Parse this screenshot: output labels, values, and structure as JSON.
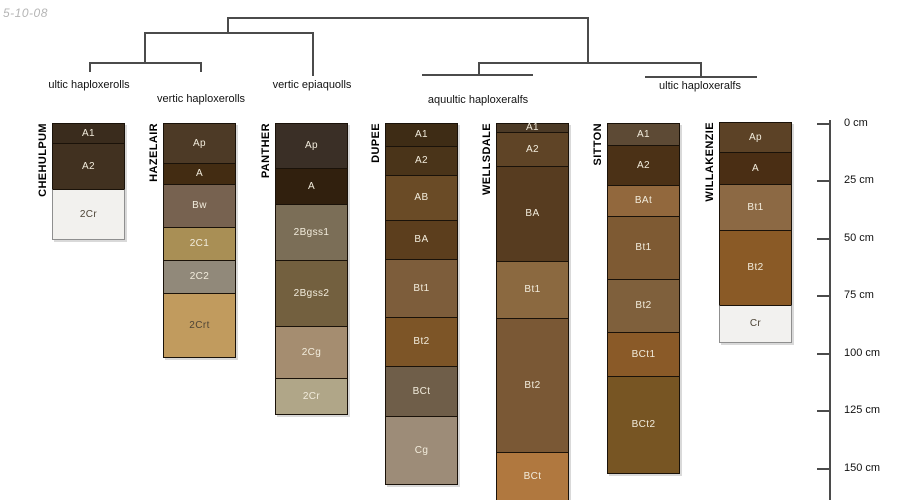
{
  "date_stamp": "5-10-08",
  "dendrogram": {
    "line_color": "#4b4b4b",
    "labels": [
      {
        "text": "ultic haploxerolls",
        "cx": 89,
        "y": 79
      },
      {
        "text": "vertic haploxerolls",
        "cx": 201,
        "y": 93
      },
      {
        "text": "vertic epiaquolls",
        "cx": 312,
        "y": 79
      },
      {
        "text": "aquultic haploxeralfs",
        "cx": 478,
        "y": 94
      },
      {
        "text": "ultic haploxeralfs",
        "cx": 700,
        "y": 80
      }
    ],
    "lines": [
      {
        "o": "h",
        "x": 227,
        "y": 17,
        "len": 362
      },
      {
        "o": "v",
        "x": 227,
        "y": 17,
        "len": 16
      },
      {
        "o": "h",
        "x": 144,
        "y": 32,
        "len": 169
      },
      {
        "o": "v",
        "x": 144,
        "y": 32,
        "len": 31
      },
      {
        "o": "h",
        "x": 89,
        "y": 62,
        "len": 112
      },
      {
        "o": "v",
        "x": 89,
        "y": 62,
        "len": 10
      },
      {
        "o": "v",
        "x": 200,
        "y": 62,
        "len": 10
      },
      {
        "o": "v",
        "x": 312,
        "y": 32,
        "len": 44
      },
      {
        "o": "v",
        "x": 587,
        "y": 17,
        "len": 46
      },
      {
        "o": "h",
        "x": 478,
        "y": 62,
        "len": 223
      },
      {
        "o": "v",
        "x": 478,
        "y": 62,
        "len": 13
      },
      {
        "o": "h",
        "x": 422,
        "y": 74,
        "len": 111
      },
      {
        "o": "v",
        "x": 700,
        "y": 62,
        "len": 15
      },
      {
        "o": "h",
        "x": 645,
        "y": 76,
        "len": 112
      }
    ]
  },
  "profiles": [
    {
      "name": "CHEHULPUM",
      "left": 52,
      "top": 123,
      "width": 73,
      "horizons": [
        {
          "label": "A1",
          "h": 21,
          "color": "#3a2c1d",
          "text": "light"
        },
        {
          "label": "A2",
          "h": 47,
          "color": "#413120",
          "text": "light"
        },
        {
          "label": "2Cr",
          "h": 51,
          "color": "#f2f1ee",
          "text": "dark",
          "frame": "gray"
        }
      ]
    },
    {
      "name": "HAZELAIR",
      "left": 163,
      "top": 123,
      "width": 73,
      "horizons": [
        {
          "label": "Ap",
          "h": 41,
          "color": "#4d3a26",
          "text": "light"
        },
        {
          "label": "A",
          "h": 22,
          "color": "#432c12",
          "text": "light"
        },
        {
          "label": "Bw",
          "h": 44,
          "color": "#776250",
          "text": "light"
        },
        {
          "label": "2C1",
          "h": 34,
          "color": "#a98f55",
          "text": "light"
        },
        {
          "label": "2C2",
          "h": 34,
          "color": "#91897a",
          "text": "light"
        },
        {
          "label": "2Crt",
          "h": 65,
          "color": "#c19b5e",
          "text": "dark"
        }
      ]
    },
    {
      "name": "PANTHER",
      "left": 275,
      "top": 123,
      "width": 73,
      "horizons": [
        {
          "label": "Ap",
          "h": 46,
          "color": "#3a2f26",
          "text": "light"
        },
        {
          "label": "A",
          "h": 37,
          "color": "#31200e",
          "text": "light"
        },
        {
          "label": "2Bgss1",
          "h": 57,
          "color": "#7b6e57",
          "text": "light"
        },
        {
          "label": "2Bgss2",
          "h": 67,
          "color": "#73603f",
          "text": "light"
        },
        {
          "label": "2Cg",
          "h": 53,
          "color": "#a58d70",
          "text": "light"
        },
        {
          "label": "2Cr",
          "h": 37,
          "color": "#b0a688",
          "text": "light"
        }
      ]
    },
    {
      "name": "DUPEE",
      "left": 385,
      "top": 123,
      "width": 73,
      "horizons": [
        {
          "label": "A1",
          "h": 24,
          "color": "#3e2c15",
          "text": "light"
        },
        {
          "label": "A2",
          "h": 30,
          "color": "#4a3419",
          "text": "light"
        },
        {
          "label": "AB",
          "h": 46,
          "color": "#6a4b26",
          "text": "light"
        },
        {
          "label": "BA",
          "h": 40,
          "color": "#5c3e1d",
          "text": "light"
        },
        {
          "label": "Bt1",
          "h": 59,
          "color": "#7d5d3b",
          "text": "light"
        },
        {
          "label": "Bt2",
          "h": 50,
          "color": "#7d5527",
          "text": "light"
        },
        {
          "label": "BCt",
          "h": 51,
          "color": "#6f5e49",
          "text": "light"
        },
        {
          "label": "Cg",
          "h": 69,
          "color": "#9d8c78",
          "text": "light"
        }
      ]
    },
    {
      "name": "WELLSDALE",
      "left": 496,
      "top": 123,
      "width": 73,
      "horizons": [
        {
          "label": "A1",
          "h": 10,
          "color": "#4c3a26",
          "text": "light"
        },
        {
          "label": "A2",
          "h": 35,
          "color": "#5f4426",
          "text": "light"
        },
        {
          "label": "BA",
          "h": 96,
          "color": "#573c20",
          "text": "light"
        },
        {
          "label": "Bt1",
          "h": 58,
          "color": "#8b6940",
          "text": "light"
        },
        {
          "label": "Bt2",
          "h": 135,
          "color": "#7a5835",
          "text": "light"
        },
        {
          "label": "BCt",
          "h": 50,
          "color": "#b0783f",
          "text": "light"
        }
      ]
    },
    {
      "name": "SITTON",
      "left": 607,
      "top": 123,
      "width": 73,
      "horizons": [
        {
          "label": "A1",
          "h": 23,
          "color": "#5d4a35",
          "text": "light"
        },
        {
          "label": "A2",
          "h": 41,
          "color": "#4b3116",
          "text": "light"
        },
        {
          "label": "BAt",
          "h": 32,
          "color": "#92683d",
          "text": "light"
        },
        {
          "label": "Bt1",
          "h": 64,
          "color": "#7e5a33",
          "text": "light"
        },
        {
          "label": "Bt2",
          "h": 54,
          "color": "#7f603c",
          "text": "light"
        },
        {
          "label": "BCt1",
          "h": 45,
          "color": "#8a5a28",
          "text": "light"
        },
        {
          "label": "BCt2",
          "h": 98,
          "color": "#775523",
          "text": "light"
        }
      ]
    },
    {
      "name": "WILLAKENZIE",
      "left": 719,
      "top": 122,
      "width": 73,
      "horizons": [
        {
          "label": "Ap",
          "h": 31,
          "color": "#5c4226",
          "text": "light"
        },
        {
          "label": "A",
          "h": 33,
          "color": "#4a2e14",
          "text": "light"
        },
        {
          "label": "Bt1",
          "h": 47,
          "color": "#8c6944",
          "text": "light"
        },
        {
          "label": "Bt2",
          "h": 76,
          "color": "#8a5a26",
          "text": "light"
        },
        {
          "label": "Cr",
          "h": 38,
          "color": "#f2f1ef",
          "text": "dark",
          "frame": "gray"
        }
      ]
    }
  ],
  "depth_scale": {
    "unit": "cm",
    "axis_x": 829,
    "axis_top": 120,
    "axis_bottom": 500,
    "tick_len": 12,
    "ticks": [
      {
        "label": "0 cm",
        "y": 123
      },
      {
        "label": "25 cm",
        "y": 180
      },
      {
        "label": "50 cm",
        "y": 238
      },
      {
        "label": "75 cm",
        "y": 295
      },
      {
        "label": "100 cm",
        "y": 353
      },
      {
        "label": "125 cm",
        "y": 410
      },
      {
        "label": "150 cm",
        "y": 468
      }
    ]
  }
}
